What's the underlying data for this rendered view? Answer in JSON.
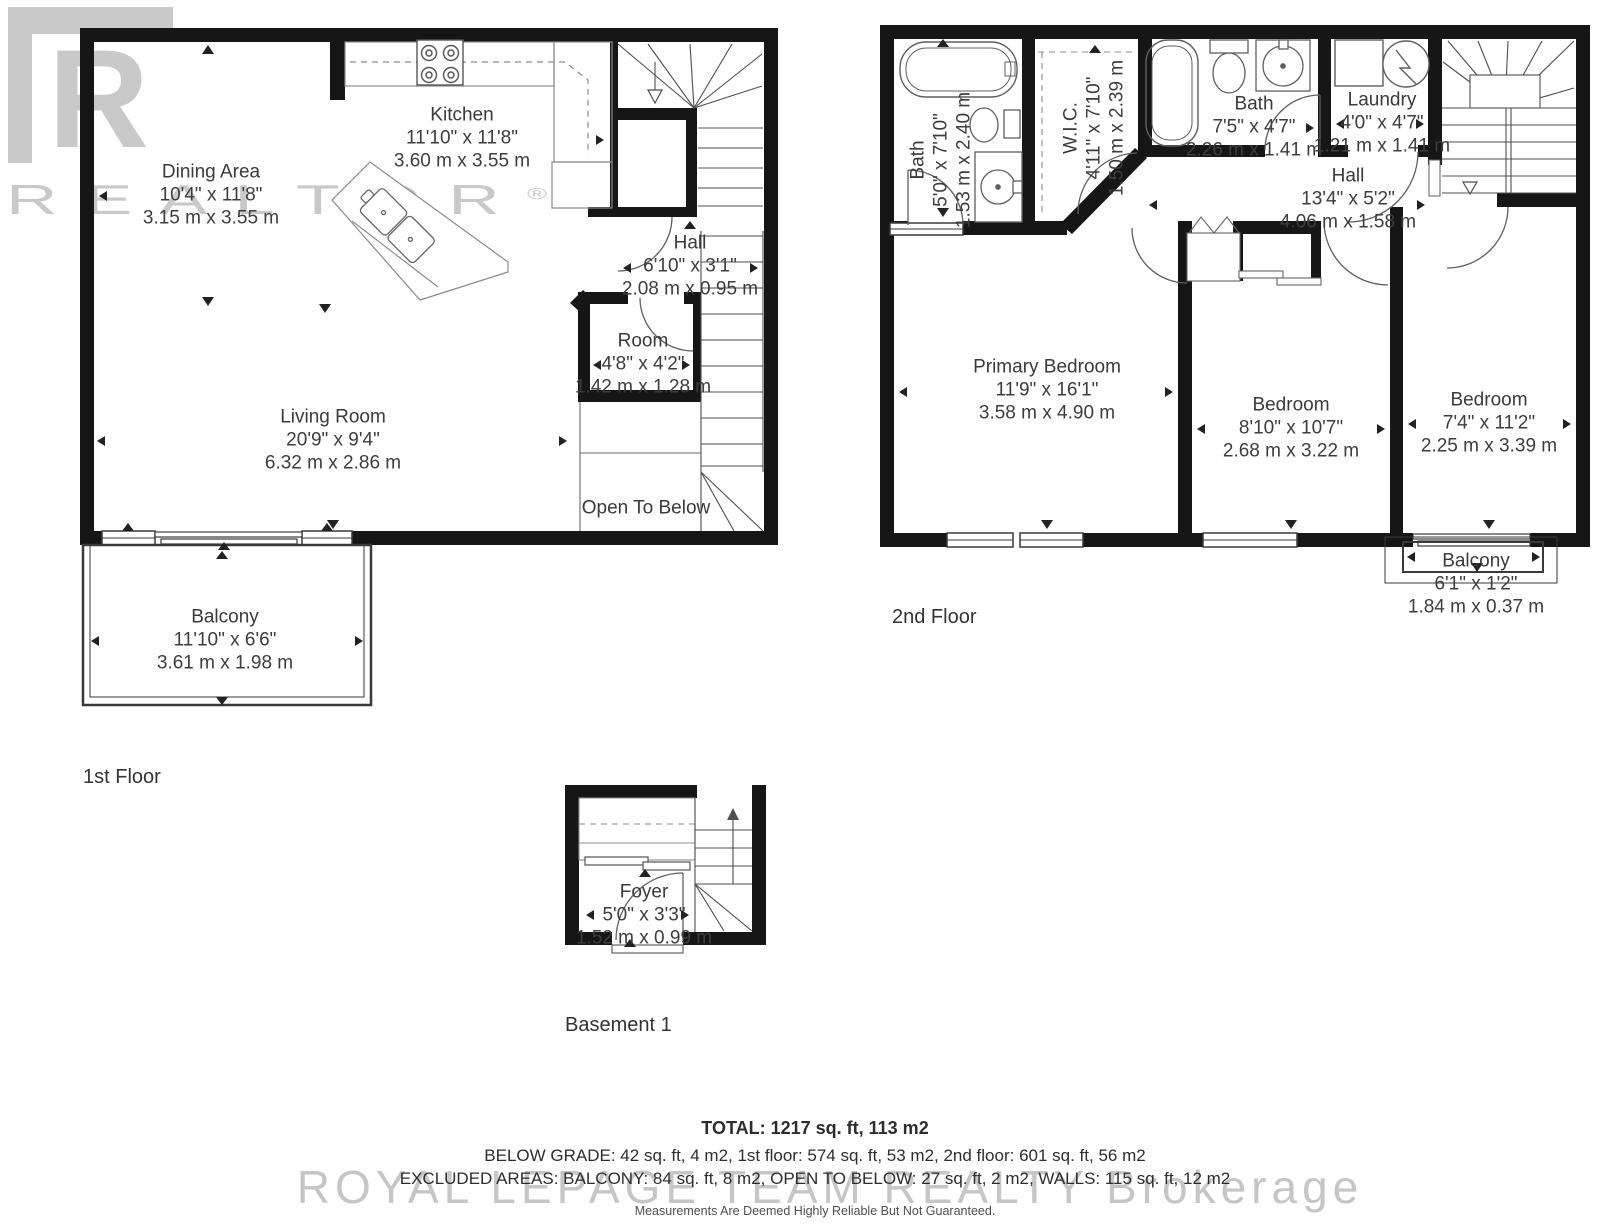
{
  "watermarks": {
    "logo_letter": "R",
    "logo_text": "REALTOR",
    "logo_reg": "®",
    "brokerage": "ROYAL LEPAGE TEAM REALTY Brokerage",
    "disclaimer": "Measurements Are Deemed Highly Reliable But Not Guaranteed."
  },
  "floors": [
    {
      "label": "1st Floor",
      "rooms": [
        {
          "name": "Dining Area",
          "imperial": "10'4\" x 11'8\"",
          "metric": "3.15 m x 3.55 m"
        },
        {
          "name": "Kitchen",
          "imperial": "11'10\" x 11'8\"",
          "metric": "3.60 m x 3.55 m"
        },
        {
          "name": "Hall",
          "imperial": "6'10\" x 3'1\"",
          "metric": "2.08 m x 0.95 m"
        },
        {
          "name": "Room",
          "imperial": "4'8\" x 4'2\"",
          "metric": "1.42 m x 1.28 m"
        },
        {
          "name": "Living Room",
          "imperial": "20'9\" x 9'4\"",
          "metric": "6.32 m x 2.86 m"
        },
        {
          "name": "Open To Below",
          "imperial": "",
          "metric": ""
        },
        {
          "name": "Balcony",
          "imperial": "11'10\" x 6'6\"",
          "metric": "3.61 m x 1.98 m"
        }
      ]
    },
    {
      "label": "2nd Floor",
      "rooms": [
        {
          "name": "Bath",
          "imperial": "5'0\" x 7'10\"",
          "metric": "1.53 m x 2.40 m"
        },
        {
          "name": "W.I.C.",
          "imperial": "4'11\" x 7'10\"",
          "metric": "1.50 m x 2.39 m"
        },
        {
          "name": "Bath",
          "imperial": "7'5\" x 4'7\"",
          "metric": "2.26 m x 1.41 m"
        },
        {
          "name": "Laundry",
          "imperial": "4'0\" x 4'7\"",
          "metric": "1.21 m x 1.41 m"
        },
        {
          "name": "Hall",
          "imperial": "13'4\" x 5'2\"",
          "metric": "4.06 m x 1.58 m"
        },
        {
          "name": "Primary Bedroom",
          "imperial": "11'9\" x 16'1\"",
          "metric": "3.58 m x 4.90 m"
        },
        {
          "name": "Bedroom",
          "imperial": "8'10\" x 10'7\"",
          "metric": "2.68 m x 3.22 m"
        },
        {
          "name": "Bedroom",
          "imperial": "7'4\" x 11'2\"",
          "metric": "2.25 m x 3.39 m"
        },
        {
          "name": "Balcony",
          "imperial": "6'1\" x 1'2\"",
          "metric": "1.84 m x 0.37 m"
        }
      ]
    },
    {
      "label": "Basement 1",
      "rooms": [
        {
          "name": "Foyer",
          "imperial": "5'0\" x 3'3\"",
          "metric": "1.52 m x 0.99 m"
        }
      ]
    }
  ],
  "summary": {
    "total": "TOTAL: 1217 sq. ft, 113 m2",
    "below_grade": "BELOW GRADE: 42 sq. ft, 4 m2, 1st floor: 574 sq. ft, 53 m2, 2nd floor: 601 sq. ft, 56 m2",
    "excluded": "EXCLUDED AREAS: BALCONY: 84 sq. ft, 8 m2, OPEN TO BELOW: 27 sq. ft, 2 m2, WALLS: 115 sq. ft, 12 m2"
  }
}
